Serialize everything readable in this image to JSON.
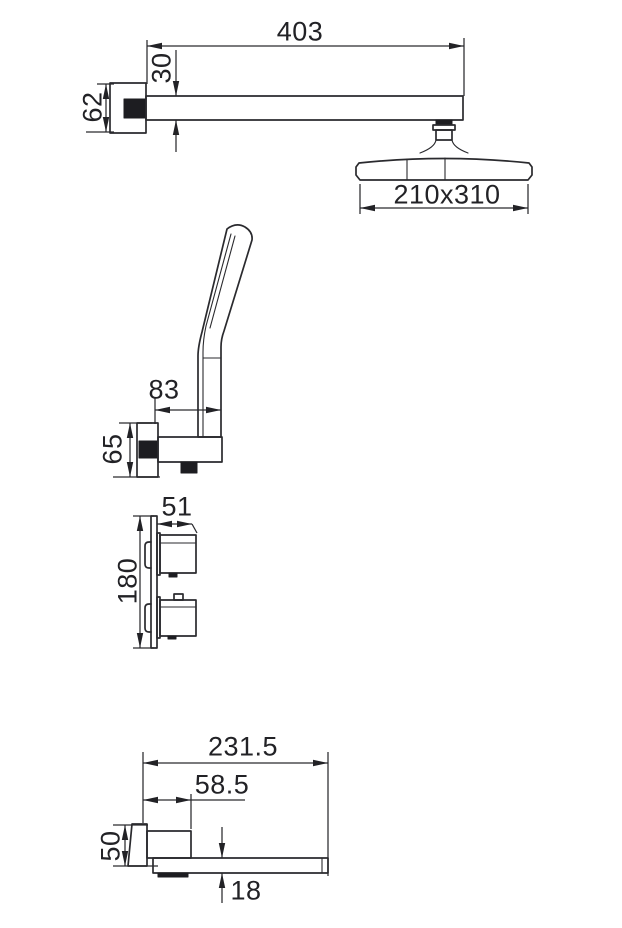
{
  "drawing": {
    "type": "technical-dimension-drawing",
    "subject": "shower-system-set",
    "line_color": "#2a2a2e",
    "background": "#ffffff",
    "views": [
      {
        "name": "overhead-shower-arm-and-head"
      },
      {
        "name": "hand-shower-on-wall-bracket"
      },
      {
        "name": "concealed-mixer-valve"
      },
      {
        "name": "wall-mounted-bath-spout"
      }
    ]
  },
  "dimensions": {
    "overhead_shower": {
      "arm_length": "403",
      "arm_thickness": "30",
      "wall_flange_size": "62",
      "head_size": "210x310"
    },
    "hand_shower": {
      "holder_reach": "83",
      "holder_flange_size": "65"
    },
    "mixer_valve": {
      "handle_depth": "51",
      "plate_height": "180"
    },
    "bath_spout": {
      "total_length": "231.5",
      "body_length": "58.5",
      "flange_size": "50",
      "spout_thickness": "18"
    }
  }
}
